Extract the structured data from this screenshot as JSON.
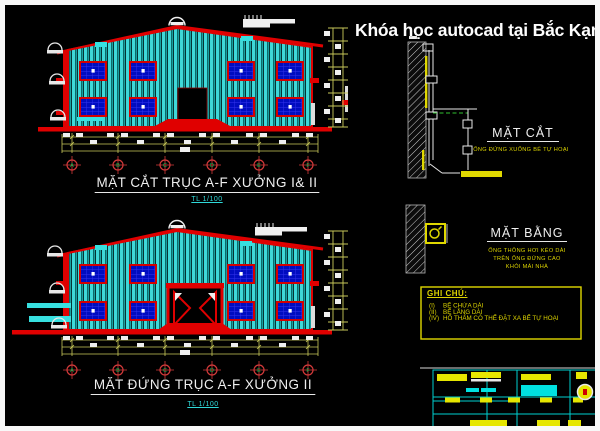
{
  "header": {
    "title": "Khóa học autocad tại Bắc Kạn"
  },
  "views": {
    "section": {
      "title": "MẶT CẮT TRỤC A-F  XƯỞNG I& II",
      "scale": "TL 1/100",
      "axes": [
        "A",
        "B",
        "C",
        "D",
        "E",
        "F"
      ]
    },
    "elevation": {
      "title": "MẶT ĐỨNG  TRỤC A-F XƯỞNG II",
      "scale": "TL 1/100",
      "axes": [
        "A",
        "B",
        "C",
        "D",
        "E",
        "F"
      ]
    }
  },
  "details": {
    "section": {
      "title": "MẶT CẮT",
      "note": "ỐNG ĐỨNG XUỐNG BỂ TỰ HOẠI"
    },
    "plan": {
      "title": "MẶT BẰNG",
      "notes": [
        "ỐNG THÔNG HƠI KÉO DÀI",
        "TRÊN ỐNG ĐỨNG CAO",
        "KHỎI MÁI NHÀ"
      ]
    }
  },
  "ghi_chu": {
    "title": "GHI CHÚ:",
    "items": [
      {
        "label": "(I)",
        "text": "BỂ CHỨA DÀI"
      },
      {
        "label": "(II)",
        "text": "BỂ LẮNG DÀI"
      },
      {
        "label": "(IV)",
        "text": "HỐ THẤM CÓ THỂ ĐẶT XA BỂ TỰ HOẠI"
      }
    ]
  },
  "colors": {
    "background": "#000000",
    "accent_red": "#e00000",
    "siding_cyan": "#3fd8d8",
    "window_blue": "#000cc0",
    "dimension_yellow": "#c9c95a",
    "detail_yellow": "#e0d800",
    "axis_green": "#00c050",
    "scale_cyan": "#2fd9d9",
    "titleblock_cyan": "#00d0d0"
  }
}
